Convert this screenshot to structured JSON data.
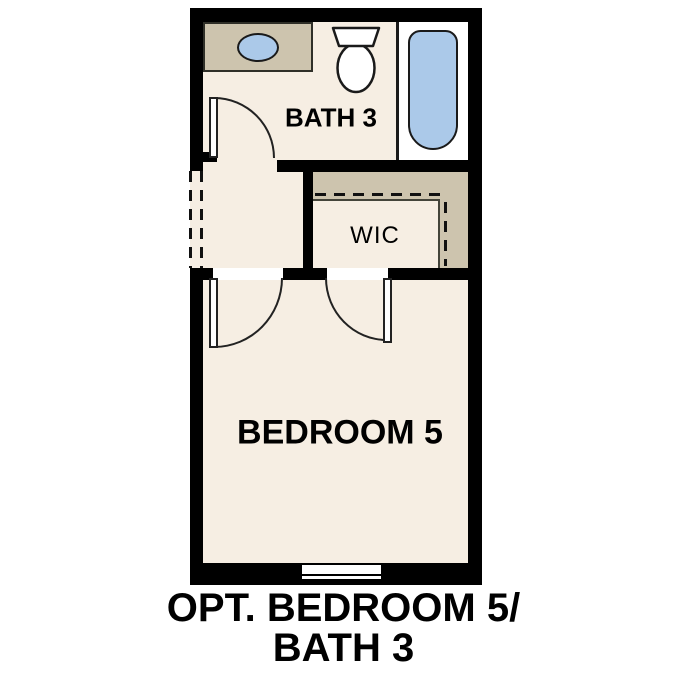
{
  "floorplan": {
    "rooms": {
      "bath": {
        "label": "BATH 3"
      },
      "wic": {
        "label": "WIC"
      },
      "bedroom": {
        "label": "BEDROOM 5"
      }
    },
    "caption": {
      "line1": "OPT. BEDROOM 5/",
      "line2": "BATH 3"
    },
    "fixtures": [
      "vanity-counter",
      "sink-basin",
      "toilet",
      "bathtub",
      "window",
      "closet-shelf",
      "closet-rod"
    ],
    "doors": [
      "bath-door-swing",
      "bedroom-door-swing",
      "wic-door-swing",
      "dashed-wall-opening"
    ],
    "colors": {
      "wall": "#000000",
      "floor": "#f6eee3",
      "tan": "#cdc4ae",
      "blue": "#abc9e9",
      "white": "#ffffff",
      "outline": "#2f2f28",
      "ink": "#000000"
    }
  }
}
